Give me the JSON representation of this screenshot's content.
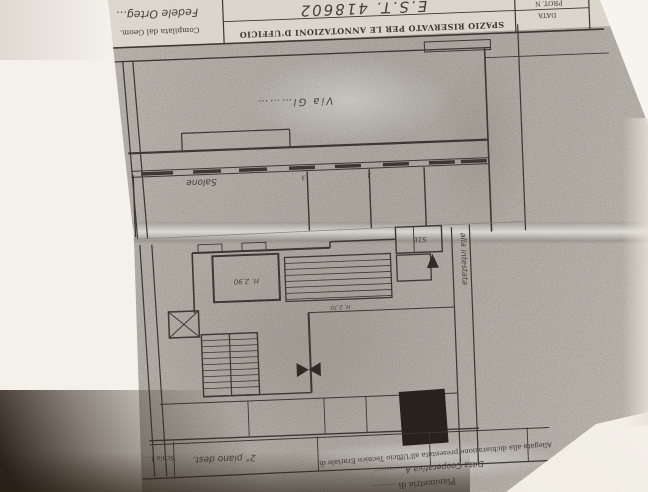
{
  "header": {
    "annotation_box_label": "SPAZIO RISERVATO PER LE ANNOTAZIONI D'UFFICIO",
    "handwritten_ref": "E.S.T. 418602",
    "prot_label": "PROT. N",
    "data_label": "DATA",
    "compiled_by_label": "Compilata dal Geom.",
    "compiled_by_signature": "Fedele Orteg…"
  },
  "plan_upper": {
    "street_label": "Via Gl………",
    "room_salone": "Salone",
    "window_mark_a": "3",
    "window_mark_b": "3"
  },
  "plan_lower": {
    "height_label": "H. 2,90",
    "small_height_label": "H. 2,70",
    "room_code": "S1b",
    "side_note": "alla intestata"
  },
  "footer": {
    "scale_entry": "Scala 1:…",
    "floor_entry": "2° piano dest.",
    "line_allegata": "Allegata alla dichiarazione presentata all'Ufficio Tecnico Erariale di",
    "line_ditta": "Ditta  Cooperativa A…………",
    "line_planimetria": "Planimetria di ………"
  },
  "colors": {
    "paper": "#c8c4bb",
    "background": "#f4f1ea",
    "ink": "#3b3731",
    "shadow": "#2c2219",
    "stamp_block": "#29221c"
  }
}
